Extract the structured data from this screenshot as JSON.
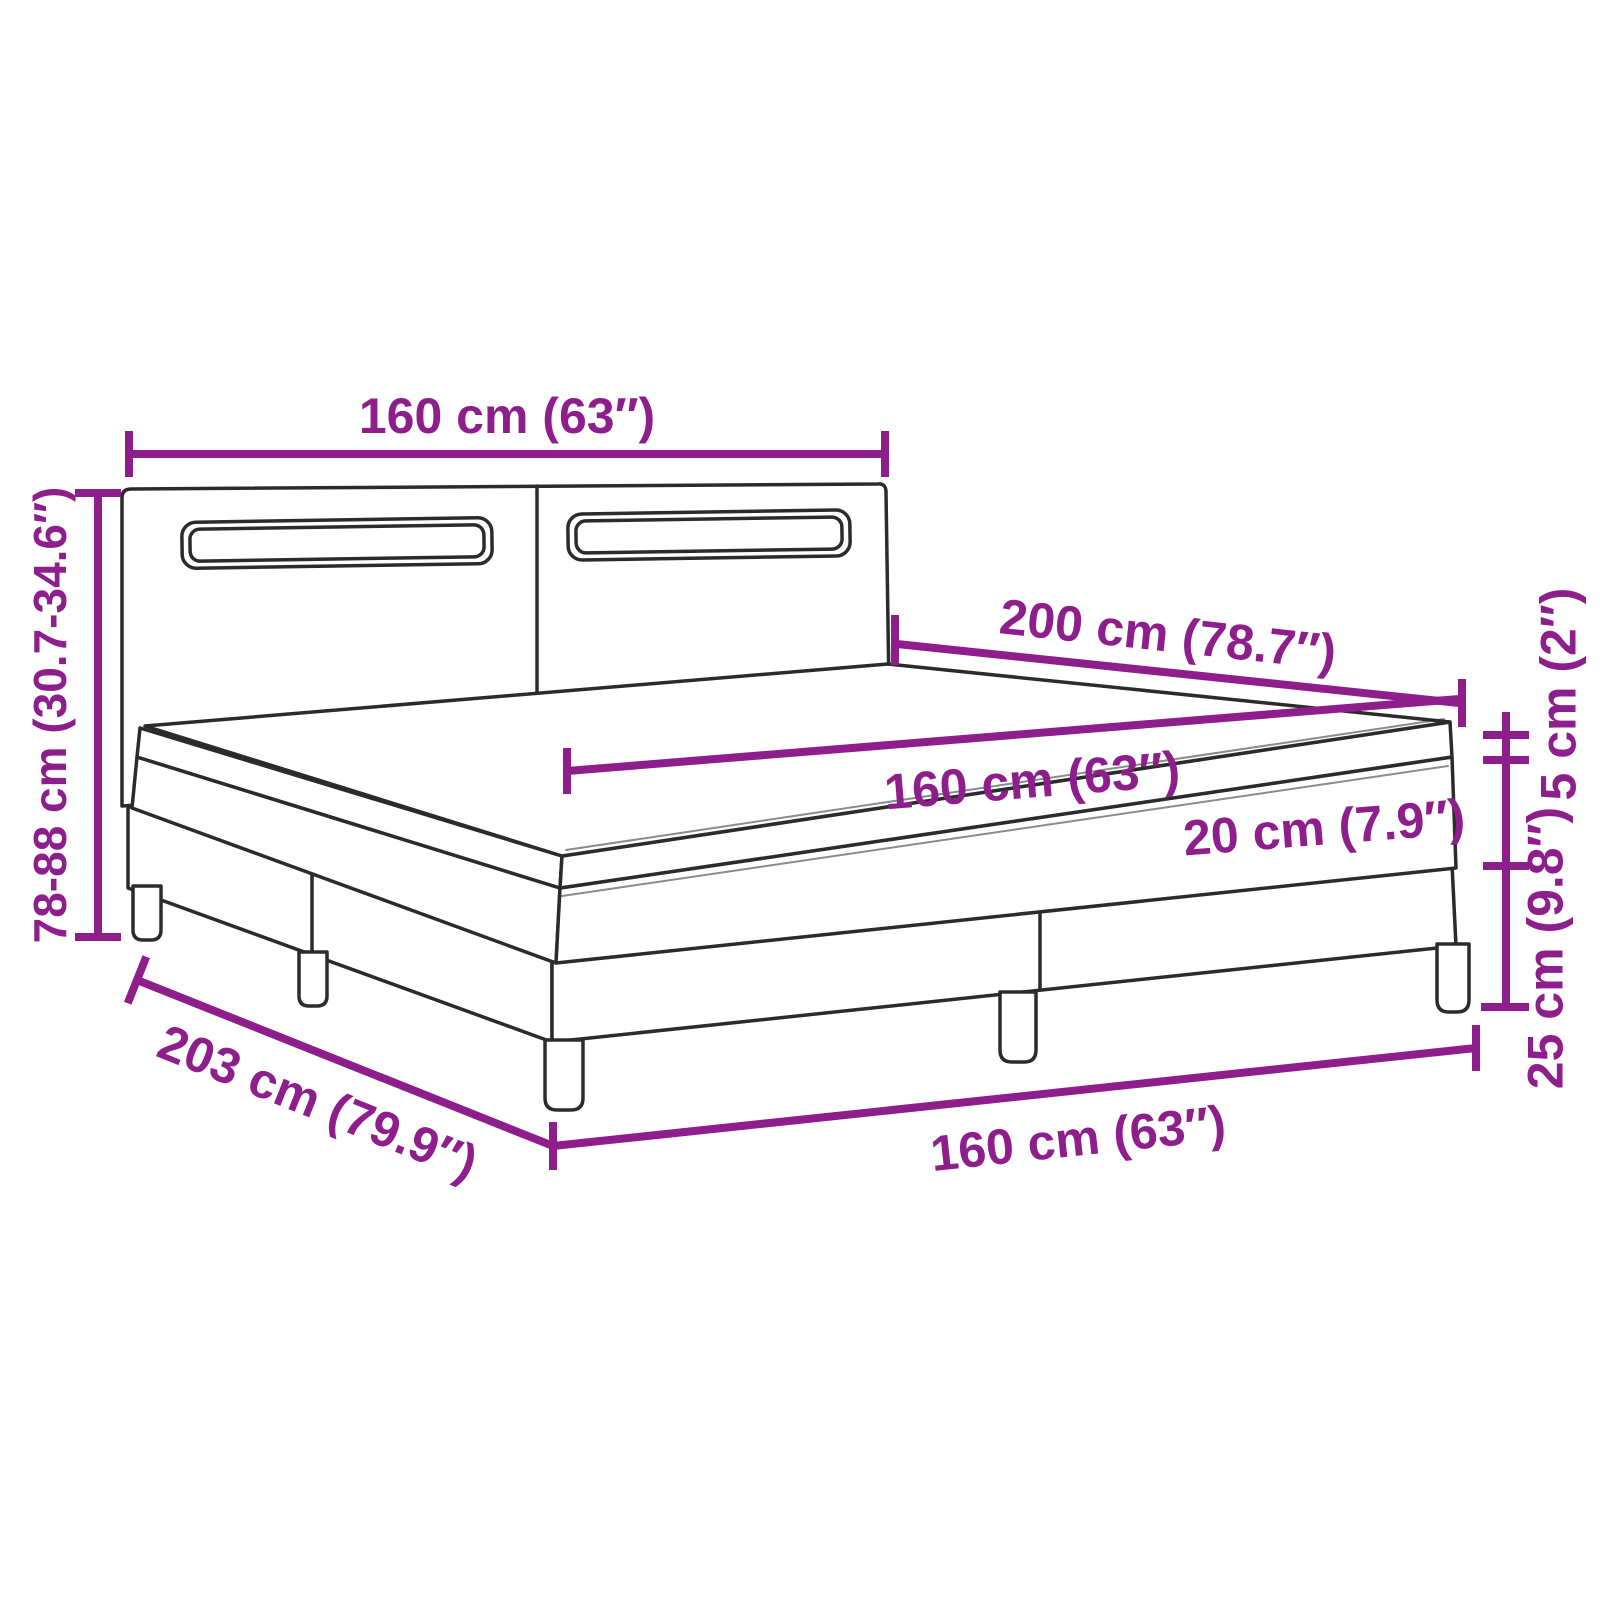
{
  "title": "Box spring bed with LED headboard – dimension diagram",
  "colors": {
    "dimension": "#8E1E8B",
    "outline": "#2b2b2b",
    "background": "#ffffff"
  },
  "labels": {
    "headboard_width": "160 cm (63″)",
    "total_height": "78-88 cm (30.7-34.6″)",
    "mattress_length": "200 cm (78.7″)",
    "mattress_width": "160 cm (63″)",
    "mattress_height": "20 cm (7.9″)",
    "topper_height": "5 cm (2″)",
    "base_height": "25 cm (9.8″)",
    "base_length": "203 cm (79.9″)",
    "base_width": "160 cm (63″)"
  }
}
